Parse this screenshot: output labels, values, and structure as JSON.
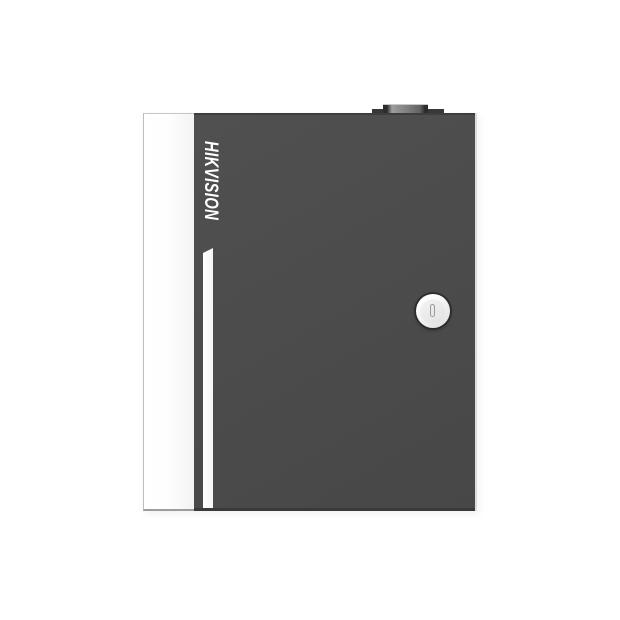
{
  "scene": {
    "type": "product-photo",
    "background_color": "#ffffff",
    "subject": "wall-mount metal access-control enclosure, front view"
  },
  "device": {
    "logo_text": "HIKVISION",
    "logo_color": "#ffffff",
    "logo_orientation": "rotated-90deg-clockwise, italic bold",
    "door_color": "#4b4b4b",
    "side_panel_color": "#ffffff",
    "accent_stripe_color": "#ffffff",
    "lock_face_color": "#f0f0f0",
    "keyhole_color": "#e9e9e9",
    "hinge_color": "#383838",
    "features": [
      "top-hinge",
      "brand-logo",
      "accent-stripe",
      "cam-lock",
      "open-side-panel"
    ]
  }
}
